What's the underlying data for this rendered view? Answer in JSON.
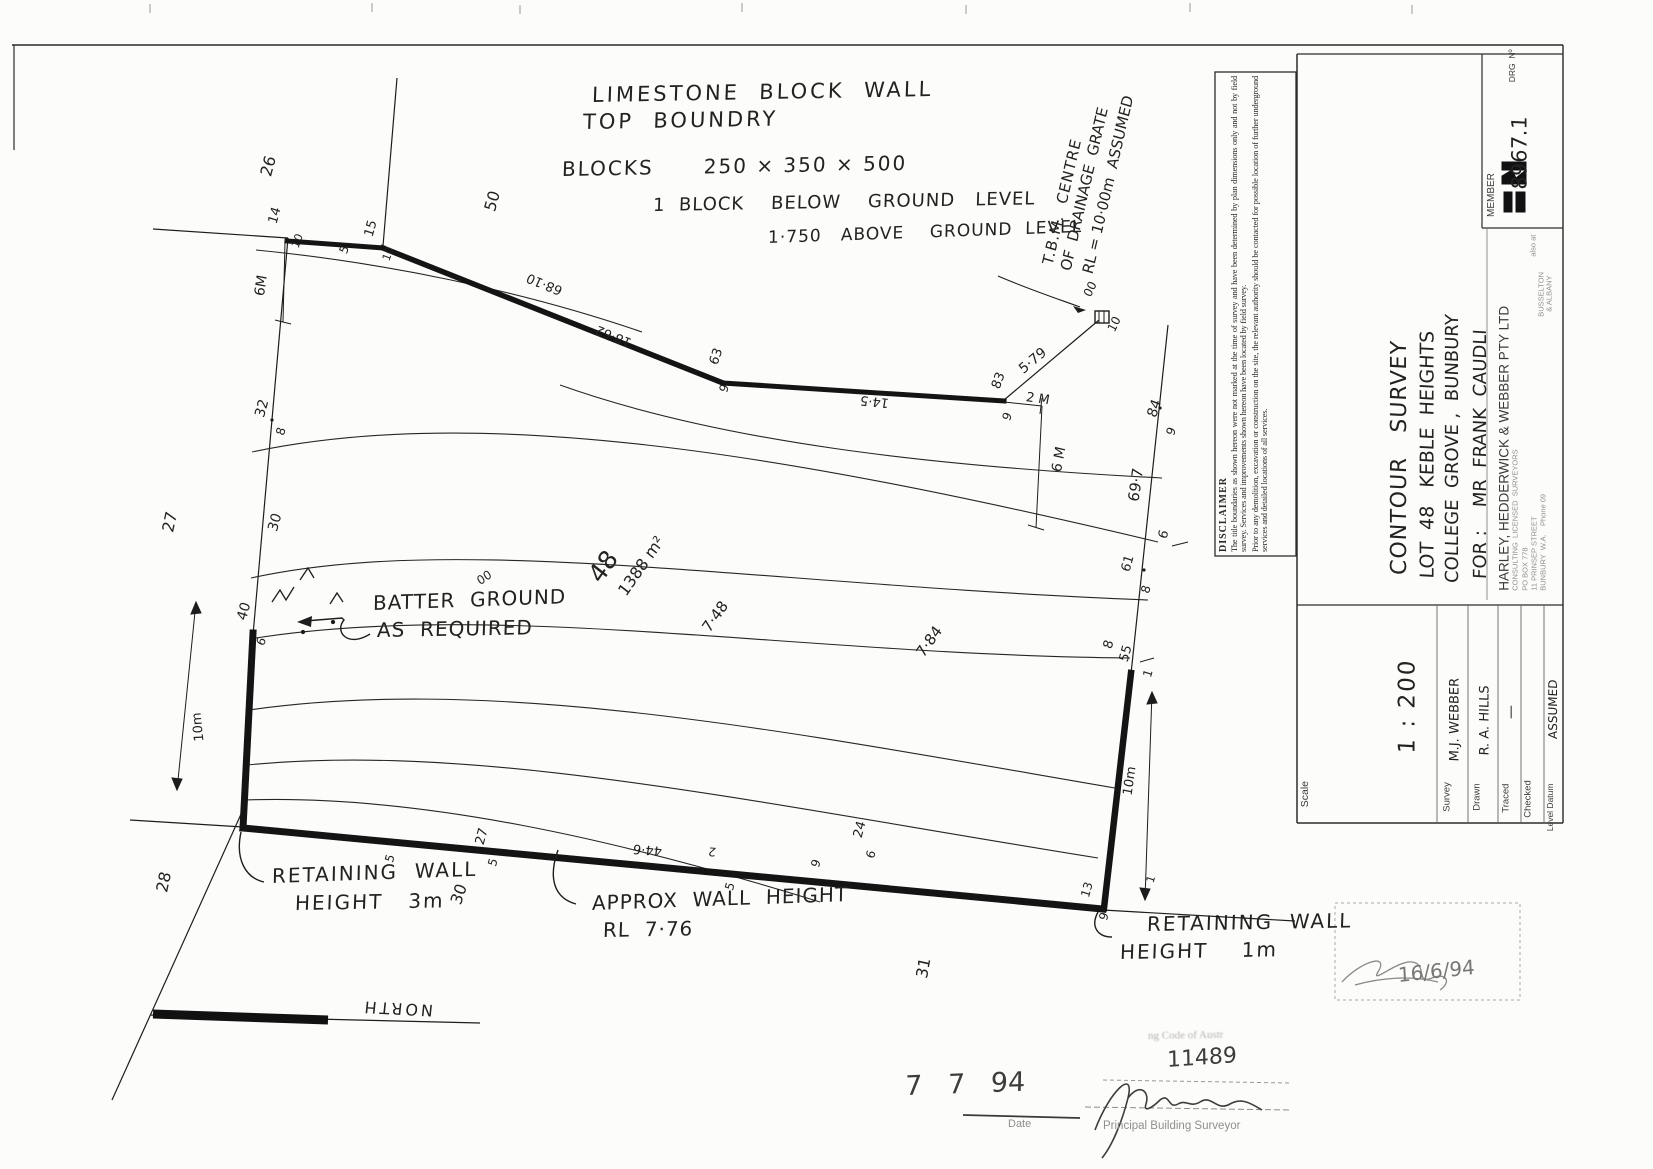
{
  "document": {
    "type": "contour survey plan (scanned)",
    "ink_color": "#1f1f1f",
    "paper_color": "#fcfcfa"
  },
  "disclaimer": {
    "header": "DISCLAIMER",
    "p1": "The title boundaries as shown hereon were not marked at the time of survey and have been determined by plan dimensions only and not by field survey.  Services and improvements shown hereon have been located by field survey.",
    "p2": "Prior to any demolition, excavation or construction on the site, the relevant authority should be contacted for possible location of further underground services and detailed locations of all services."
  },
  "labels": [
    {
      "n": "note-limestone-1",
      "t": "LIMESTONE  BLOCK  WALL",
      "x": 592,
      "y": 106,
      "r": -1,
      "s": 21,
      "ls": 3,
      "c": "h"
    },
    {
      "n": "note-limestone-2",
      "t": "TOP  BOUNDRY",
      "x": 583,
      "y": 133,
      "r": -1,
      "s": 21,
      "ls": 3,
      "c": "h"
    },
    {
      "n": "note-blocks",
      "t": "BLOCKS      250 × 350 × 500",
      "x": 562,
      "y": 179,
      "r": -1,
      "s": 20,
      "ls": 2,
      "c": "h"
    },
    {
      "n": "note-block-below",
      "t": "1  BLOCK    BELOW    GROUND   LEVEL",
      "x": 653,
      "y": 215,
      "r": -1,
      "s": 18,
      "ls": 1,
      "c": "h"
    },
    {
      "n": "note-block-above",
      "t": "1·750   ABOVE    GROUND  LEVEL",
      "x": 768,
      "y": 247,
      "r": -2,
      "s": 17,
      "ls": 1,
      "c": "h"
    },
    {
      "n": "tbm-note-line-1",
      "t": "T.B.M.  CENTRE",
      "x": 1048,
      "y": 272,
      "r": -77,
      "s": 15,
      "ls": 1,
      "c": "h"
    },
    {
      "n": "tbm-note-line-2",
      "t": "OF  DRAINAGE  GRATE",
      "x": 1066,
      "y": 278,
      "r": -77,
      "s": 15,
      "c": "h"
    },
    {
      "n": "tbm-note-line-3",
      "t": "RL = 10·00m  ASSUMED",
      "x": 1088,
      "y": 281,
      "r": -77,
      "s": 15,
      "c": "h"
    },
    {
      "n": "note-batter-1",
      "t": "BATTER  GROUND",
      "x": 373,
      "y": 613,
      "r": -2,
      "s": 20,
      "ls": 1,
      "c": "h"
    },
    {
      "n": "note-batter-2",
      "t": "AS  REQUIRED",
      "x": 377,
      "y": 640,
      "r": -1,
      "s": 20,
      "ls": 1,
      "c": "h"
    },
    {
      "n": "note-retaining3m-1",
      "t": "RETAINING  WALL",
      "x": 272,
      "y": 886,
      "r": -2,
      "s": 20,
      "ls": 2,
      "c": "h"
    },
    {
      "n": "note-retaining3m-2",
      "t": "HEIGHT   3m",
      "x": 295,
      "y": 913,
      "r": -1,
      "s": 20,
      "ls": 2,
      "c": "h"
    },
    {
      "n": "note-approx-1",
      "t": "APPROX  WALL  HEIGHT",
      "x": 592,
      "y": 913,
      "r": -2,
      "s": 20,
      "ls": 1,
      "c": "h"
    },
    {
      "n": "note-approx-2",
      "t": "RL  7·76",
      "x": 603,
      "y": 940,
      "r": -1,
      "s": 20,
      "ls": 1,
      "c": "h"
    },
    {
      "n": "note-retaining1m-1",
      "t": "RETAINING  WALL",
      "x": 1147,
      "y": 934,
      "r": -1,
      "s": 20,
      "ls": 2,
      "c": "h"
    },
    {
      "n": "note-retaining1m-2",
      "t": "HEIGHT    1m",
      "x": 1120,
      "y": 962,
      "r": -1,
      "s": 20,
      "ls": 2,
      "c": "h"
    },
    {
      "n": "lot-number",
      "t": "48",
      "x": 594,
      "y": 592,
      "r": -55,
      "s": 25,
      "c": "h"
    },
    {
      "n": "lot-area",
      "t": "1388 m²",
      "x": 622,
      "y": 602,
      "r": -55,
      "s": 16,
      "c": "h"
    },
    {
      "n": "spot-7-48",
      "t": "7·48",
      "x": 706,
      "y": 638,
      "r": -55,
      "s": 15,
      "c": "h"
    },
    {
      "n": "spot-7-84",
      "t": "7·84",
      "x": 920,
      "y": 663,
      "r": -55,
      "s": 15,
      "c": "h"
    },
    {
      "n": "lot-26",
      "t": "26",
      "x": 266,
      "y": 184,
      "r": -75,
      "s": 16,
      "c": "h"
    },
    {
      "n": "lot-50",
      "t": "50",
      "x": 490,
      "y": 219,
      "r": -75,
      "s": 16,
      "c": "h"
    },
    {
      "n": "lot-27",
      "t": "27",
      "x": 168,
      "y": 540,
      "r": -78,
      "s": 16,
      "c": "h"
    },
    {
      "n": "lot-28",
      "t": "28",
      "x": 162,
      "y": 900,
      "r": -78,
      "s": 16,
      "c": "h"
    },
    {
      "n": "lot-30-left",
      "t": "30",
      "x": 273,
      "y": 538,
      "r": -75,
      "s": 14,
      "c": "h"
    },
    {
      "n": "lot-30-bottom",
      "t": "30",
      "x": 456,
      "y": 912,
      "r": -72,
      "s": 16,
      "c": "h"
    },
    {
      "n": "lot-31",
      "t": "31",
      "x": 922,
      "y": 986,
      "r": -80,
      "s": 16,
      "c": "h"
    },
    {
      "n": "pt-14",
      "t": "14",
      "x": 273,
      "y": 230,
      "r": -75,
      "s": 13,
      "c": "h"
    },
    {
      "n": "pt-15",
      "t": "15",
      "x": 369,
      "y": 243,
      "r": -75,
      "s": 13,
      "c": "h"
    },
    {
      "n": "level-10-a",
      "t": "10",
      "x": 295,
      "y": 253,
      "r": -70,
      "s": 11,
      "c": "h"
    },
    {
      "n": "level-5-a",
      "t": "5",
      "x": 343,
      "y": 259,
      "r": -70,
      "s": 12,
      "c": "h"
    },
    {
      "n": "level-10-b",
      "t": "10",
      "x": 386,
      "y": 266,
      "r": -72,
      "s": 11,
      "c": "h"
    },
    {
      "n": "dim-6m-left",
      "t": "6M",
      "x": 260,
      "y": 303,
      "r": -82,
      "s": 14,
      "c": "h"
    },
    {
      "n": "pt-32",
      "t": "32",
      "x": 260,
      "y": 424,
      "r": -75,
      "s": 14,
      "c": "h"
    },
    {
      "n": "level-8-a",
      "t": "8",
      "x": 280,
      "y": 441,
      "r": -75,
      "s": 12,
      "c": "h"
    },
    {
      "n": "pt-40",
      "t": "40",
      "x": 242,
      "y": 627,
      "r": -75,
      "s": 14,
      "c": "h"
    },
    {
      "n": "level-6-a",
      "t": "6",
      "x": 260,
      "y": 651,
      "r": -70,
      "s": 12,
      "c": "h"
    },
    {
      "n": "dim-10m-left",
      "t": "10m",
      "x": 200,
      "y": 748,
      "r": -96,
      "s": 13,
      "c": "h"
    },
    {
      "n": "bearing-68-10",
      "t": "68·10",
      "x": 562,
      "y": 297,
      "r": 202,
      "s": 13,
      "c": "h"
    },
    {
      "n": "dim-18-62",
      "t": "18·62",
      "x": 631,
      "y": 349,
      "r": 202,
      "s": 13,
      "c": "h"
    },
    {
      "n": "pt-63",
      "t": "63",
      "x": 714,
      "y": 371,
      "r": -72,
      "s": 13,
      "c": "h"
    },
    {
      "n": "level-9-a",
      "t": "9",
      "x": 723,
      "y": 398,
      "r": -72,
      "s": 12,
      "c": "h"
    },
    {
      "n": "dim-14-5",
      "t": "14·5",
      "x": 889,
      "y": 409,
      "r": 186,
      "s": 13,
      "c": "h"
    },
    {
      "n": "pt-83",
      "t": "83",
      "x": 996,
      "y": 395,
      "r": -70,
      "s": 13,
      "c": "h"
    },
    {
      "n": "level-9-b",
      "t": "9",
      "x": 1006,
      "y": 426,
      "r": -70,
      "s": 12,
      "c": "h"
    },
    {
      "n": "dim-5-79",
      "t": "5·79",
      "x": 1021,
      "y": 378,
      "r": -40,
      "s": 14,
      "c": "h"
    },
    {
      "n": "dim-2m",
      "t": "2 M",
      "x": 1026,
      "y": 404,
      "r": 8,
      "s": 13,
      "c": "h"
    },
    {
      "n": "dim-6m-right",
      "t": "6 M",
      "x": 1057,
      "y": 479,
      "r": -80,
      "s": 14,
      "c": "h"
    },
    {
      "n": "level-00-grate",
      "t": "00",
      "x": 1087,
      "y": 302,
      "r": -65,
      "s": 12,
      "c": "h"
    },
    {
      "n": "level-10-grate",
      "t": "10",
      "x": 1111,
      "y": 337,
      "r": -65,
      "s": 12,
      "c": "h"
    },
    {
      "n": "pt-84",
      "t": "84",
      "x": 1152,
      "y": 424,
      "r": -72,
      "s": 14,
      "c": "h"
    },
    {
      "n": "level-9-c",
      "t": "9",
      "x": 1170,
      "y": 441,
      "r": -72,
      "s": 12,
      "c": "h"
    },
    {
      "n": "dim-69-7",
      "t": "69·7",
      "x": 1134,
      "y": 509,
      "r": -82,
      "s": 15,
      "c": "h"
    },
    {
      "n": "contour-6",
      "t": "6",
      "x": 1163,
      "y": 545,
      "r": -75,
      "s": 13,
      "c": "h"
    },
    {
      "n": "pt-61",
      "t": "61",
      "x": 1126,
      "y": 578,
      "r": -75,
      "s": 13,
      "c": "h"
    },
    {
      "n": "level-8-b",
      "t": "8",
      "x": 1145,
      "y": 599,
      "r": -75,
      "s": 12,
      "c": "h"
    },
    {
      "n": "contour-8",
      "t": "8",
      "x": 1108,
      "y": 655,
      "r": -75,
      "s": 13,
      "c": "h"
    },
    {
      "n": "pt-55",
      "t": "55",
      "x": 1124,
      "y": 668,
      "r": -75,
      "s": 13,
      "c": "h"
    },
    {
      "n": "level-1-a",
      "t": "1",
      "x": 1147,
      "y": 683,
      "r": -75,
      "s": 12,
      "c": "h"
    },
    {
      "n": "dim-10m-right",
      "t": "10m",
      "x": 1128,
      "y": 802,
      "r": -82,
      "s": 13,
      "c": "h"
    },
    {
      "n": "level-1-b",
      "t": "1",
      "x": 1150,
      "y": 888,
      "r": -75,
      "s": 11,
      "c": "h"
    },
    {
      "n": "contour-00",
      "t": "00",
      "x": 478,
      "y": 588,
      "r": -35,
      "s": 12,
      "c": "h"
    },
    {
      "n": "level-5-b",
      "t": "5",
      "x": 389,
      "y": 868,
      "r": -75,
      "s": 12,
      "c": "h"
    },
    {
      "n": "pt-27b",
      "t": "27",
      "x": 480,
      "y": 851,
      "r": -75,
      "s": 13,
      "c": "h"
    },
    {
      "n": "level-5-c",
      "t": "5",
      "x": 492,
      "y": 872,
      "r": -75,
      "s": 12,
      "c": "h"
    },
    {
      "n": "dim-44-6",
      "t": "44·6",
      "x": 662,
      "y": 857,
      "r": 185,
      "s": 13,
      "c": "h"
    },
    {
      "n": "level-2-a",
      "t": "2",
      "x": 716,
      "y": 858,
      "r": 185,
      "s": 12,
      "c": "h"
    },
    {
      "n": "level-5-d",
      "t": "5",
      "x": 729,
      "y": 896,
      "r": -75,
      "s": 12,
      "c": "h"
    },
    {
      "n": "level-9-d",
      "t": "9",
      "x": 815,
      "y": 873,
      "r": -75,
      "s": 12,
      "c": "h"
    },
    {
      "n": "pt-24",
      "t": "24",
      "x": 858,
      "y": 844,
      "r": -75,
      "s": 13,
      "c": "h"
    },
    {
      "n": "level-6-b",
      "t": "6",
      "x": 870,
      "y": 864,
      "r": -75,
      "s": 12,
      "c": "h"
    },
    {
      "n": "pt-13",
      "t": "13",
      "x": 1085,
      "y": 903,
      "r": -75,
      "s": 12,
      "c": "h"
    },
    {
      "n": "level-9-e",
      "t": "9",
      "x": 1103,
      "y": 926,
      "r": -75,
      "s": 12,
      "c": "h"
    },
    {
      "n": "north-label",
      "t": "NORTH",
      "x": 433,
      "y": 1018,
      "r": 183,
      "s": 16,
      "ls": 3,
      "c": "h"
    },
    {
      "n": "title-line-1",
      "t": "CONTOUR   SURVEY",
      "x": 1400,
      "y": 586,
      "r": -90,
      "s": 22,
      "ls": 1,
      "c": "h"
    },
    {
      "n": "title-line-2",
      "t": "LOT  48   KEBLE  HEIGHTS",
      "x": 1428,
      "y": 588,
      "r": -90,
      "s": 19,
      "c": "h"
    },
    {
      "n": "title-line-3",
      "t": "COLLEGE  GROVE ,  BUNBURY",
      "x": 1453,
      "y": 592,
      "r": -90,
      "s": 18,
      "c": "h"
    },
    {
      "n": "client-line",
      "t": "FOR :    MR  FRANK  CAUDLI",
      "x": 1481,
      "y": 588,
      "r": -90,
      "s": 18,
      "c": "h"
    },
    {
      "n": "firm-name",
      "t": "HARLEY, HEDDERWICK & WEBBER PTY LTD",
      "x": 1504,
      "y": 597,
      "r": -90,
      "s": 13.5,
      "c": "p"
    },
    {
      "n": "firm-subtitle",
      "t": "CONSULTING  LICENSED  SURVEYORS",
      "x": 1515,
      "y": 594,
      "r": -90,
      "s": 7.5,
      "c": "f"
    },
    {
      "n": "firm-pobox",
      "t": "PO BOX 778",
      "x": 1525,
      "y": 594,
      "r": -90,
      "s": 7.5,
      "c": "f"
    },
    {
      "n": "firm-street",
      "t": "11 PRINSEP STREET",
      "x": 1534,
      "y": 594,
      "r": -90,
      "s": 7.5,
      "c": "f"
    },
    {
      "n": "firm-city",
      "t": "BUNBURY  W.A.    Phone 09",
      "x": 1543,
      "y": 594,
      "r": -90,
      "s": 7.5,
      "c": "f"
    },
    {
      "n": "firm-also-at",
      "t": "also at",
      "x": 1533,
      "y": 260,
      "r": -90,
      "s": 7.5,
      "c": "f"
    },
    {
      "n": "firm-busselton",
      "t": "BUSSELTON",
      "x": 1541,
      "y": 320,
      "r": -90,
      "s": 7.5,
      "c": "f"
    },
    {
      "n": "firm-albany",
      "t": "& ALBANY",
      "x": 1549,
      "y": 315,
      "r": -90,
      "s": 7.5,
      "c": "f"
    },
    {
      "n": "member-label",
      "t": "MEMBER",
      "x": 1492,
      "y": 222,
      "r": -90,
      "s": 10,
      "c": "p"
    },
    {
      "n": "drg-no-label",
      "t": "DRG  Nº",
      "x": 1512,
      "y": 86,
      "r": -90,
      "s": 8.5,
      "c": "p"
    },
    {
      "n": "drg-no-value",
      "t": "8967.1",
      "x": 1520,
      "y": 200,
      "r": -90,
      "s": 21,
      "c": "h"
    },
    {
      "n": "scale-label",
      "t": "Scale",
      "x": 1305,
      "y": 812,
      "r": -90,
      "s": 10.5,
      "c": "p"
    },
    {
      "n": "scale-value",
      "t": "1 : 200",
      "x": 1408,
      "y": 765,
      "r": -90,
      "s": 23,
      "ls": 2,
      "c": "h"
    },
    {
      "n": "survey-label",
      "t": "Survey",
      "x": 1447,
      "y": 816,
      "r": -90,
      "s": 9.5,
      "c": "p"
    },
    {
      "n": "survey-value",
      "t": "M.J. WEBBER",
      "x": 1455,
      "y": 768,
      "r": -90,
      "s": 13,
      "c": "h"
    },
    {
      "n": "drawn-label",
      "t": "Drawn",
      "x": 1477,
      "y": 815,
      "r": -90,
      "s": 9.5,
      "c": "p"
    },
    {
      "n": "drawn-value",
      "t": "R. A. HILLS",
      "x": 1485,
      "y": 762,
      "r": -90,
      "s": 13,
      "c": "h"
    },
    {
      "n": "traced-label",
      "t": "Traced",
      "x": 1506,
      "y": 817,
      "r": -90,
      "s": 9.5,
      "c": "p"
    },
    {
      "n": "traced-value",
      "t": "—",
      "x": 1511,
      "y": 726,
      "r": -90,
      "s": 14,
      "c": "h"
    },
    {
      "n": "checked-label",
      "t": "Checked",
      "x": 1528,
      "y": 822,
      "r": -90,
      "s": 9.5,
      "c": "p"
    },
    {
      "n": "level-datum-label",
      "t": "Level Datum",
      "x": 1550,
      "y": 835,
      "r": -90,
      "s": 8.5,
      "c": "p"
    },
    {
      "n": "level-datum-value",
      "t": "ASSUMED",
      "x": 1553,
      "y": 745,
      "r": -90,
      "s": 12,
      "c": "h"
    },
    {
      "n": "approval-number",
      "t": "11489",
      "x": 1167,
      "y": 1072,
      "r": -4,
      "s": 22,
      "c": "h2"
    },
    {
      "n": "approval-date",
      "t": "7   7   94",
      "x": 905,
      "y": 1100,
      "r": -2,
      "s": 27,
      "c": "h2"
    },
    {
      "n": "date-label",
      "t": "Date",
      "x": 1008,
      "y": 1130,
      "r": 0,
      "s": 11,
      "c": "f"
    },
    {
      "n": "surveyor-label",
      "t": "Principal Building Surveyor",
      "x": 1103,
      "y": 1132,
      "r": 0,
      "s": 11.5,
      "c": "f"
    },
    {
      "n": "stamp-fragment",
      "t": "ng Code of Austr",
      "x": 1148,
      "y": 1042,
      "r": -1,
      "s": 11,
      "c": "xf"
    },
    {
      "n": "stamp-date-2",
      "t": "16/6/94",
      "x": 1398,
      "y": 985,
      "r": -6,
      "s": 20,
      "c": "h2f"
    }
  ]
}
